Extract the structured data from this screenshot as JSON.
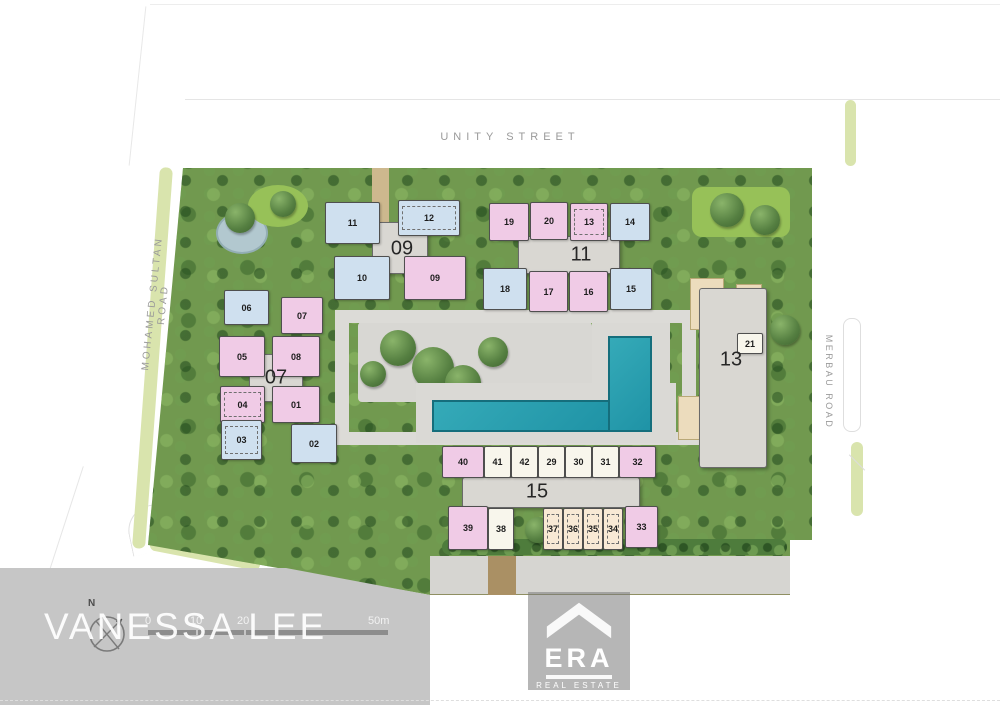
{
  "roads": {
    "unity_street": "UNITY STREET",
    "mohamed_sultan_road": "MOHAMED SULTAN ROAD",
    "merbau_road": "MERBAU ROAD"
  },
  "watermark": "VANESSA LEE",
  "logo": {
    "brand": "ERA",
    "tagline": "REAL ESTATE"
  },
  "compass": {
    "north_label": "N"
  },
  "scale_bar": {
    "ticks": [
      "0",
      "10",
      "20",
      "50m"
    ]
  },
  "colors": {
    "unit_blue": "#cfe0ef",
    "unit_pink": "#f0cbe6",
    "unit_cream": "#f8f6ec",
    "unit_peach": "#f8e9d5",
    "building_core": "#d9d7d2",
    "pool": "#2ba3b3",
    "landscape_green": "#71994f",
    "road_verge": "#d9e4ad",
    "band_gray": "#c6c6c6"
  },
  "blocks": [
    {
      "label": "09",
      "core": {
        "x": 372,
        "y": 222,
        "w": 56,
        "h": 52
      },
      "label_pos": {
        "x": 402,
        "y": 249
      },
      "units": [
        {
          "no": "11",
          "color": "blue",
          "x": 325,
          "y": 202,
          "w": 55,
          "h": 42
        },
        {
          "no": "12",
          "color": "blue",
          "x": 398,
          "y": 200,
          "w": 62,
          "h": 36,
          "dashed": true
        },
        {
          "no": "10",
          "color": "blue",
          "x": 334,
          "y": 256,
          "w": 56,
          "h": 44
        },
        {
          "no": "09",
          "color": "pink",
          "x": 404,
          "y": 256,
          "w": 62,
          "h": 44
        }
      ]
    },
    {
      "label": "11",
      "core": {
        "x": 518,
        "y": 236,
        "w": 102,
        "h": 38
      },
      "label_pos": {
        "x": 581,
        "y": 255
      },
      "units": [
        {
          "no": "19",
          "color": "pink",
          "x": 489,
          "y": 203,
          "w": 40,
          "h": 38
        },
        {
          "no": "20",
          "color": "pink",
          "x": 530,
          "y": 202,
          "w": 38,
          "h": 38
        },
        {
          "no": "13",
          "color": "pink",
          "x": 570,
          "y": 203,
          "w": 38,
          "h": 38,
          "dashed": true
        },
        {
          "no": "14",
          "color": "blue",
          "x": 610,
          "y": 203,
          "w": 40,
          "h": 38
        },
        {
          "no": "18",
          "color": "blue",
          "x": 483,
          "y": 268,
          "w": 44,
          "h": 42
        },
        {
          "no": "17",
          "color": "pink",
          "x": 529,
          "y": 271,
          "w": 39,
          "h": 41
        },
        {
          "no": "16",
          "color": "pink",
          "x": 569,
          "y": 271,
          "w": 39,
          "h": 41
        },
        {
          "no": "15",
          "color": "blue",
          "x": 610,
          "y": 268,
          "w": 42,
          "h": 42
        }
      ]
    },
    {
      "label": "07",
      "core": {
        "x": 249,
        "y": 354,
        "w": 54,
        "h": 48
      },
      "label_pos": {
        "x": 276,
        "y": 378
      },
      "units": [
        {
          "no": "06",
          "color": "blue",
          "x": 224,
          "y": 290,
          "w": 45,
          "h": 35
        },
        {
          "no": "07",
          "color": "pink",
          "x": 281,
          "y": 297,
          "w": 42,
          "h": 37
        },
        {
          "no": "05",
          "color": "pink",
          "x": 219,
          "y": 336,
          "w": 46,
          "h": 41
        },
        {
          "no": "08",
          "color": "pink",
          "x": 272,
          "y": 336,
          "w": 48,
          "h": 41
        },
        {
          "no": "04",
          "color": "pink",
          "x": 220,
          "y": 386,
          "w": 45,
          "h": 37,
          "dashed": true
        },
        {
          "no": "01",
          "color": "pink",
          "x": 272,
          "y": 386,
          "w": 48,
          "h": 37
        },
        {
          "no": "03",
          "color": "blue",
          "x": 221,
          "y": 420,
          "w": 41,
          "h": 40,
          "dashed": true
        },
        {
          "no": "02",
          "color": "blue",
          "x": 291,
          "y": 424,
          "w": 46,
          "h": 39
        }
      ]
    },
    {
      "label": "13",
      "core": {
        "x": 699,
        "y": 288,
        "w": 68,
        "h": 180
      },
      "label_pos": {
        "x": 731,
        "y": 360
      },
      "units": [
        {
          "no": "21",
          "color": "cream",
          "x": 737,
          "y": 333,
          "w": 26,
          "h": 21
        }
      ]
    },
    {
      "label": "15",
      "core": {
        "x": 462,
        "y": 477,
        "w": 178,
        "h": 31
      },
      "label_pos": {
        "x": 537,
        "y": 492
      },
      "units": [
        {
          "no": "40",
          "color": "pink",
          "x": 442,
          "y": 446,
          "w": 42,
          "h": 32
        },
        {
          "no": "41",
          "color": "cream",
          "x": 484,
          "y": 446,
          "w": 27,
          "h": 32
        },
        {
          "no": "42",
          "color": "cream",
          "x": 511,
          "y": 446,
          "w": 27,
          "h": 32
        },
        {
          "no": "29",
          "color": "cream",
          "x": 538,
          "y": 446,
          "w": 27,
          "h": 32
        },
        {
          "no": "30",
          "color": "cream",
          "x": 565,
          "y": 446,
          "w": 27,
          "h": 32
        },
        {
          "no": "31",
          "color": "cream",
          "x": 592,
          "y": 446,
          "w": 27,
          "h": 32
        },
        {
          "no": "32",
          "color": "pink",
          "x": 619,
          "y": 446,
          "w": 37,
          "h": 32
        },
        {
          "no": "39",
          "color": "pink",
          "x": 448,
          "y": 506,
          "w": 40,
          "h": 44
        },
        {
          "no": "38",
          "color": "cream",
          "x": 488,
          "y": 508,
          "w": 26,
          "h": 42
        },
        {
          "no": "37",
          "color": "peach",
          "x": 543,
          "y": 508,
          "w": 20,
          "h": 42,
          "dashed": true
        },
        {
          "no": "36",
          "color": "peach",
          "x": 563,
          "y": 508,
          "w": 20,
          "h": 42,
          "dashed": true
        },
        {
          "no": "35",
          "color": "peach",
          "x": 583,
          "y": 508,
          "w": 20,
          "h": 42,
          "dashed": true
        },
        {
          "no": "34",
          "color": "peach",
          "x": 603,
          "y": 508,
          "w": 20,
          "h": 42,
          "dashed": true
        },
        {
          "no": "33",
          "color": "pink",
          "x": 625,
          "y": 506,
          "w": 33,
          "h": 42
        }
      ]
    }
  ]
}
